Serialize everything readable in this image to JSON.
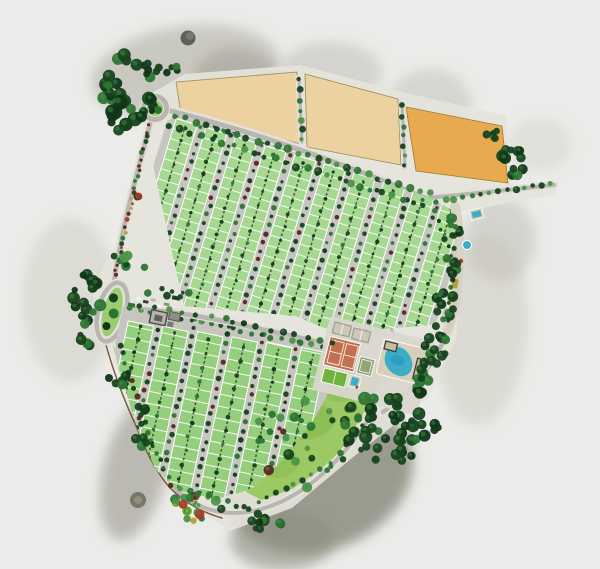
{
  "scene": {
    "type": "residential-community-master-plan",
    "style": "watercolor-aerial-illustration",
    "canvas": {
      "width": 600,
      "height": 569
    },
    "text_content": "none — illustration only"
  },
  "palette": {
    "background": "#ebebe9",
    "wash_gray": "#c2c1b8",
    "wash_gray_dark": "#a7a69b",
    "wash_olive": "#8d8e80",
    "wash_light": "#d9d8d0",
    "site_base": "#e6e4db",
    "road": "#b7b6b1",
    "sidewalk": "#e3e1d9",
    "lot_upper": "#a6d892",
    "lot_lower": "#95cf7d",
    "lot_line": "#ffffff",
    "hedge": "#25371e",
    "tree_dark": "#16431d",
    "tree_deep": "#0f3617",
    "tree_mid": "#2c7434",
    "tree_light": "#4c9447",
    "tree_maroon": "#5a2522",
    "parcel_sand": "#ecd2a0",
    "parcel_orange": "#e9a94e",
    "lawn": "#9cc963",
    "lawn_dark": "#85b94f",
    "clay_court": "#c2704f",
    "sport_field": "#6fb23c",
    "padel_frame": "#94a291",
    "padel_fill": "#cfc6b8",
    "multicourt": "#93a578",
    "pool_water": "#3cadc9",
    "pool_deep": "#2b93b4",
    "pool_deck": "#d8cfba",
    "wall": "#6e4f30",
    "flower_red": "#b23527",
    "bush_yellow": "#b0a23c",
    "building": "#b6b4ac",
    "building_dark": "#45453f",
    "car_white": "#f2f2ee",
    "car_dark": "#3c3c38",
    "roundabout_green": "#9ccb72"
  },
  "features": [
    {
      "id": "north-roundabout",
      "kind": "traffic-circle"
    },
    {
      "id": "entry-oval-roundabout",
      "kind": "landscaped-oval"
    },
    {
      "id": "future-development-parcel-1",
      "kind": "vacant-parcel",
      "color": "#ecd2a0"
    },
    {
      "id": "future-development-parcel-2",
      "kind": "vacant-parcel",
      "color": "#ecd2a0"
    },
    {
      "id": "future-development-parcel-3",
      "kind": "vacant-parcel",
      "color": "#e9a94e"
    },
    {
      "id": "upper-residential-section",
      "kind": "housing-blocks",
      "block_columns": 10
    },
    {
      "id": "lower-residential-section",
      "kind": "housing-blocks",
      "block_columns": 6
    },
    {
      "id": "tennis-courts",
      "kind": "sport",
      "color": "#c2704f"
    },
    {
      "id": "padel-courts",
      "kind": "sport"
    },
    {
      "id": "multi-sport-court",
      "kind": "sport"
    },
    {
      "id": "sports-field",
      "kind": "sport",
      "color": "#6fb23c"
    },
    {
      "id": "swimming-pool",
      "kind": "amenity",
      "color": "#3cadc9"
    },
    {
      "id": "kids-pool",
      "kind": "amenity"
    },
    {
      "id": "east-linear-park",
      "kind": "amenity-strip"
    },
    {
      "id": "community-lawn",
      "kind": "park"
    },
    {
      "id": "south-tip-garden",
      "kind": "park"
    },
    {
      "id": "gatehouse-buildings",
      "kind": "buildings"
    },
    {
      "id": "entry-parking-cars",
      "kind": "vehicles"
    },
    {
      "id": "perimeter-tree-masses",
      "kind": "vegetation"
    },
    {
      "id": "watercolor-washes",
      "kind": "background-art"
    }
  ]
}
